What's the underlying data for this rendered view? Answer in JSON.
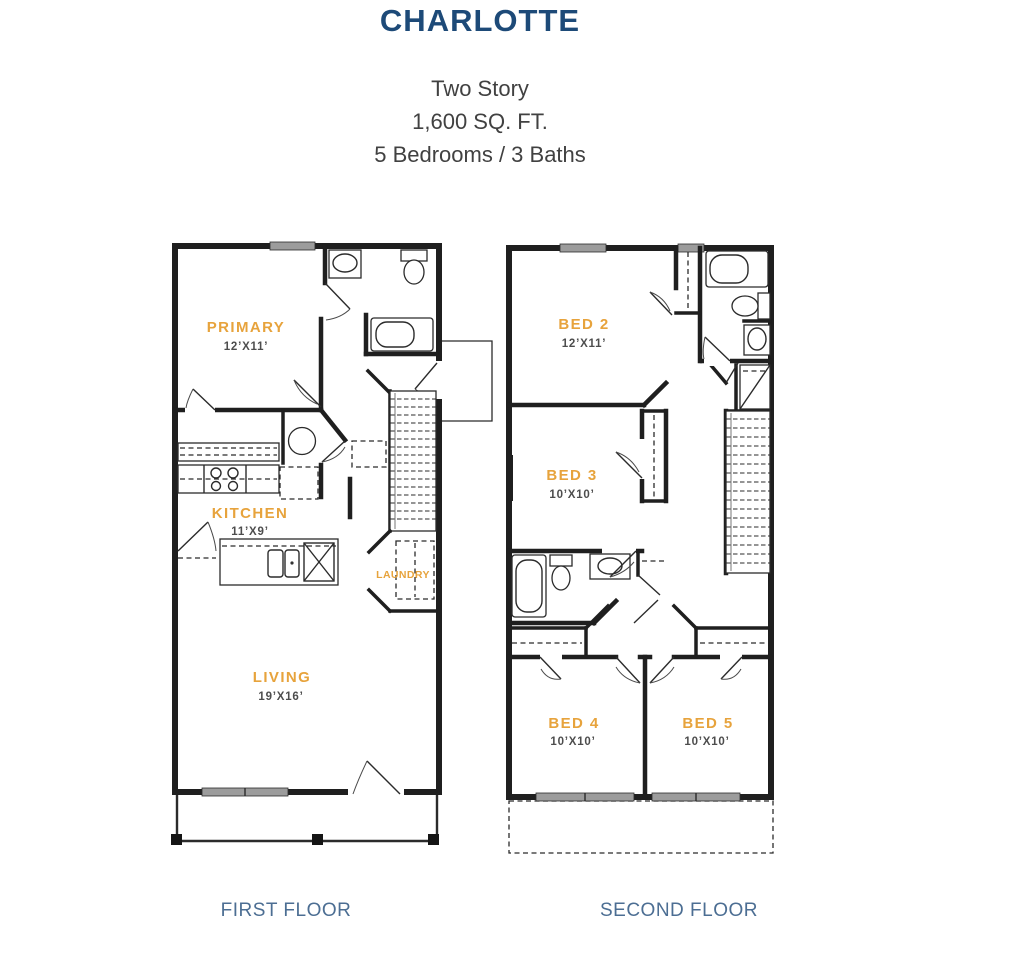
{
  "header": {
    "title": "CHARLOTTE",
    "subtitle_lines": [
      "Two Story",
      "1,600 SQ. FT.",
      "5 Bedrooms / 3 Baths"
    ]
  },
  "colors": {
    "title_navy": "#1d4a78",
    "subtitle_gray": "#414141",
    "room_label_orange": "#e7a33c",
    "dimension_gray": "#4d4d4d",
    "floor_caption_blue": "#4c6e93",
    "wall_black": "#1f1f1f"
  },
  "first_floor": {
    "caption": "FIRST FLOOR",
    "rooms": [
      {
        "name": "PRIMARY",
        "dims": "12’X11’"
      },
      {
        "name": "KITCHEN",
        "dims": "11’X9’"
      },
      {
        "name": "LAUNDRY",
        "dims": ""
      },
      {
        "name": "LIVING",
        "dims": "19’X16’"
      }
    ]
  },
  "second_floor": {
    "caption": "SECOND FLOOR",
    "rooms": [
      {
        "name": "BED 2",
        "dims": "12’X11’"
      },
      {
        "name": "BED 3",
        "dims": "10’X10’"
      },
      {
        "name": "BED 4",
        "dims": "10’X10’"
      },
      {
        "name": "BED 5",
        "dims": "10’X10’"
      }
    ]
  }
}
